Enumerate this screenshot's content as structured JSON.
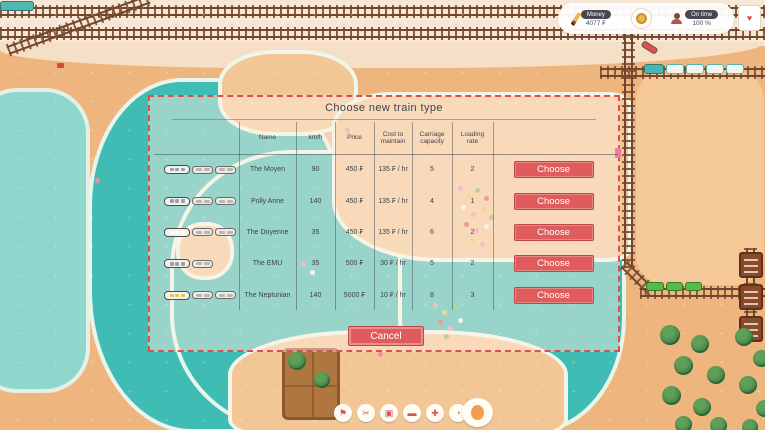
{
  "hud": {
    "money_label": "Money",
    "money_value": "4077 ₣",
    "ontime_label": "On time",
    "ontime_value": "100 %"
  },
  "dialog": {
    "title": "Choose new train type",
    "columns": [
      "Name",
      "km/h",
      "Price",
      "Cost to maintain",
      "Carriage capacity",
      "Loading rate"
    ],
    "choose_label": "Choose",
    "cancel_label": "Cancel",
    "trains": [
      {
        "name": "The Moyen",
        "speed": "90",
        "price": "450 ₣",
        "cost": "135 ₣ / hr",
        "capacity": "5",
        "loading": "2",
        "cars": 3,
        "window": "#9aa0a6"
      },
      {
        "name": "Polly Anne",
        "speed": "140",
        "price": "450 ₣",
        "cost": "135 ₣ / hr",
        "capacity": "4",
        "loading": "1",
        "cars": 3,
        "window": "#9aa0a6"
      },
      {
        "name": "The Doyenne",
        "speed": "35",
        "price": "450 ₣",
        "cost": "135 ₣ / hr",
        "capacity": "6",
        "loading": "2",
        "cars": 3,
        "window": "#ffffff"
      },
      {
        "name": "The EMU",
        "speed": "35",
        "price": "500 ₣",
        "cost": "30 ₣ / hr",
        "capacity": "5",
        "loading": "2",
        "cars": 2,
        "window": "#9aa0a6"
      },
      {
        "name": "The Neptunian",
        "speed": "140",
        "price": "5000 ₣",
        "cost": "10 ₣ / hr",
        "capacity": "8",
        "loading": "3",
        "cars": 3,
        "window": "#e8c64a"
      }
    ]
  },
  "toolbar": {
    "buttons": [
      {
        "name": "pointer-tool",
        "icon": "flag-icon",
        "glyph": "⚑"
      },
      {
        "name": "demolish-tool",
        "icon": "scissors-icon",
        "glyph": "✂"
      },
      {
        "name": "station-tool",
        "icon": "station-icon",
        "glyph": "▣"
      },
      {
        "name": "train-tool",
        "icon": "train-icon",
        "glyph": "▬"
      },
      {
        "name": "signal-tool",
        "icon": "signal-icon",
        "glyph": "✚"
      },
      {
        "name": "timer-tool",
        "icon": "clock-icon",
        "glyph": "◔"
      }
    ]
  },
  "colors": {
    "accent_red": "#e05c5c",
    "water": "#3fbcb4",
    "sand": "#eeb67e",
    "dialog_border": "#dd4f4b",
    "hud_label_bg": "#474750"
  }
}
